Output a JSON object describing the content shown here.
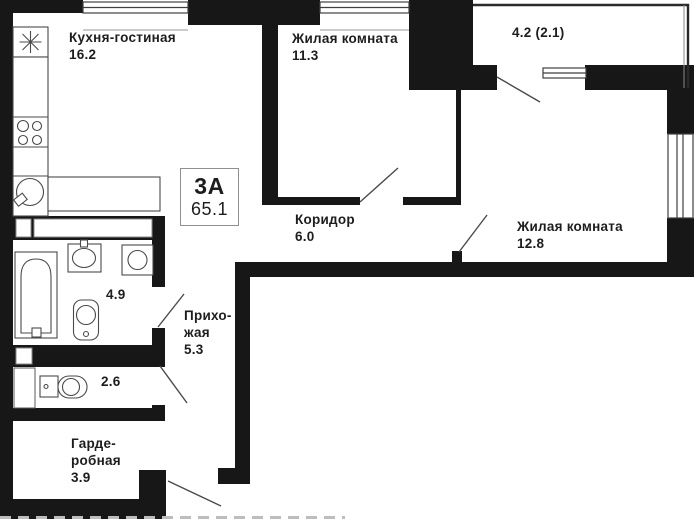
{
  "plan": {
    "title": "apartment-floor-plan",
    "badge": {
      "type": "3A",
      "total_area": "65.1"
    },
    "rooms": [
      {
        "name": "kitchen-living",
        "label_lines": [
          "Кухня-гостиная"
        ],
        "area": "16.2"
      },
      {
        "name": "living-room-1",
        "label_lines": [
          "Жилая комната"
        ],
        "area": "11.3"
      },
      {
        "name": "balcony",
        "label_lines": [],
        "area": "4.2 (2.1)"
      },
      {
        "name": "corridor",
        "label_lines": [
          "Коридор"
        ],
        "area": "6.0"
      },
      {
        "name": "living-room-2",
        "label_lines": [
          "Жилая комната"
        ],
        "area": "12.8"
      },
      {
        "name": "bathroom",
        "label_lines": [],
        "area": "4.9"
      },
      {
        "name": "hallway",
        "label_lines": [
          "Прихо-",
          "жая"
        ],
        "area": "5.3"
      },
      {
        "name": "wc",
        "label_lines": [],
        "area": "2.6"
      },
      {
        "name": "wardrobe",
        "label_lines": [
          "Гарде-",
          "робная"
        ],
        "area": "3.9"
      }
    ],
    "fixtures": [
      "vent-icon",
      "stove-icon",
      "kitchen-sink-icon",
      "counter",
      "bathtub-icon",
      "washbasin-icon",
      "washing-machine-icon",
      "toilet-icon",
      "wc-toilet-icon",
      "vent-shaft"
    ],
    "colors": {
      "wall": "#171717",
      "line": "#4a4a4a",
      "text": "#1d1d1d",
      "badge_border": "#8f8f8f",
      "background": "#ffffff"
    }
  }
}
